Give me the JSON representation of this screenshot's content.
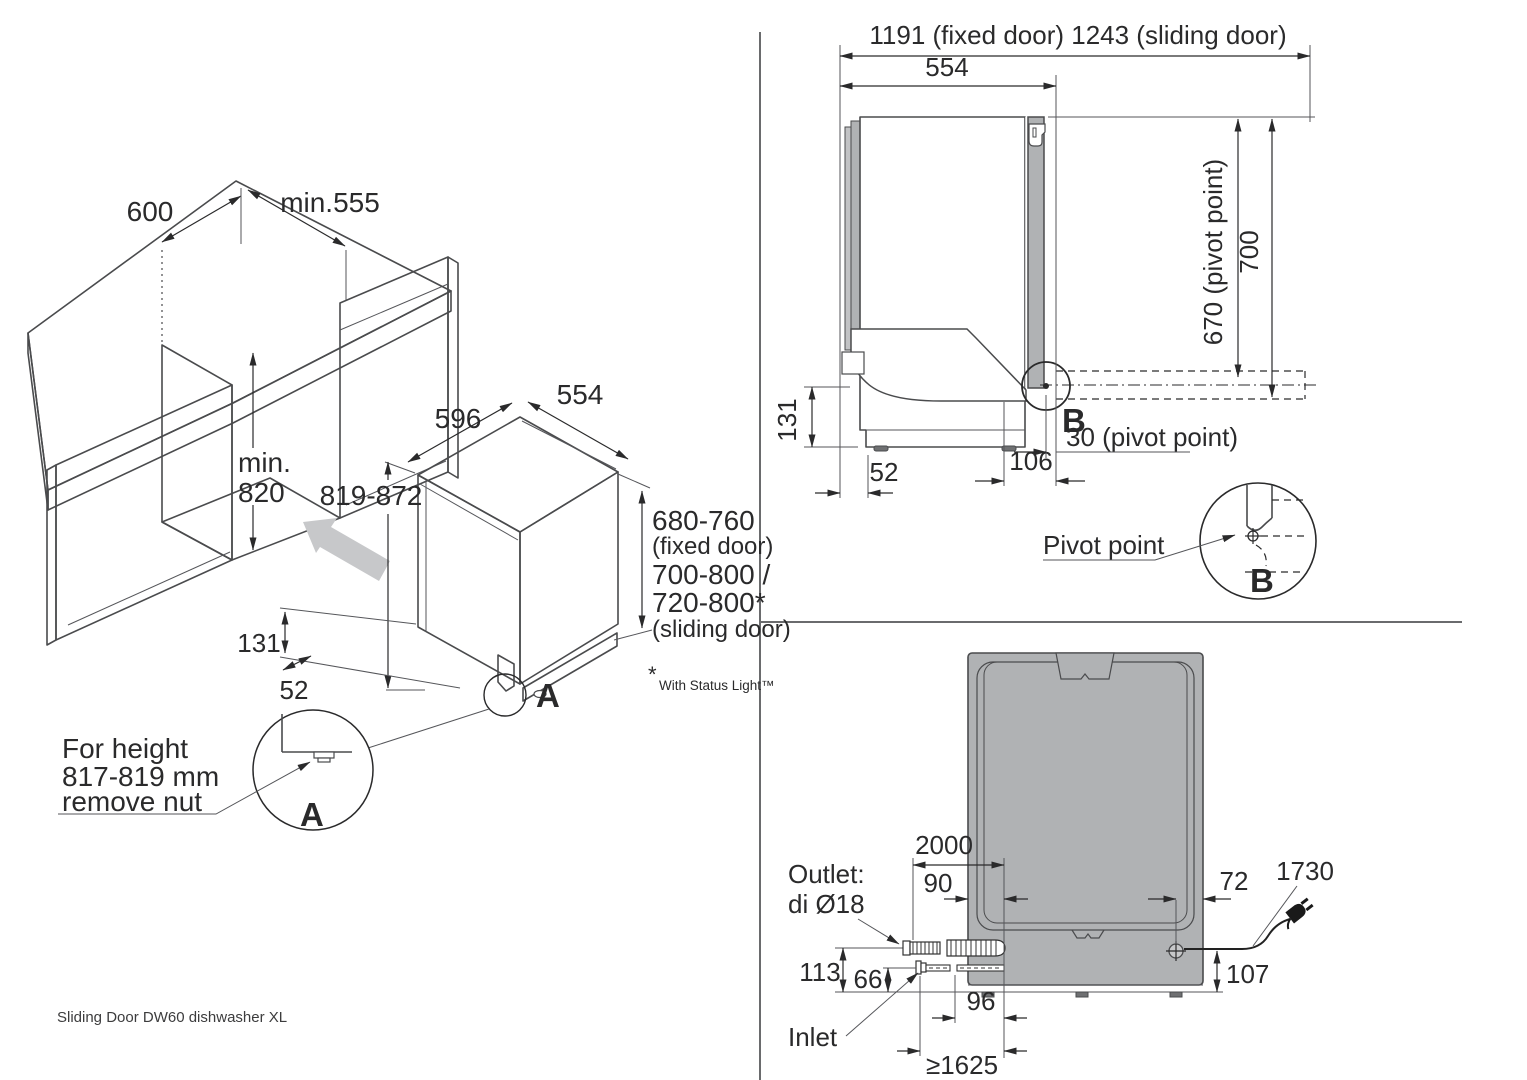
{
  "caption": "Sliding Door DW60 dishwasher XL",
  "footnote": {
    "star": "*",
    "text": "With Status Light™"
  },
  "cabinet": {
    "opening_width": "600",
    "opening_depth": "min.555",
    "opening_height_line1": "min.",
    "opening_height_line2": "820"
  },
  "iso": {
    "width": "596",
    "depth": "554",
    "height_range": "819-872",
    "plinth_height": "131",
    "toe_depth": "52",
    "door_fixed": "680-760",
    "door_fixed_note": "(fixed door)",
    "door_sliding_1": "700-800 /",
    "door_sliding_2": "720-800*",
    "door_sliding_note": "(sliding door)",
    "detail_label": "A"
  },
  "detail_a": {
    "note_line1": "For height",
    "note_line2": "817-819 mm",
    "note_line3": "remove nut",
    "label": "A"
  },
  "side": {
    "total_depth": "1191 (fixed door) 1243 (sliding door)",
    "body_depth": "554",
    "pivot_height": "670 (pivot point)",
    "total_height": "700",
    "plinth_height": "131",
    "toe_depth": "52",
    "pivot_offset": "106",
    "pivot_note": "30 (pivot point)",
    "detail_label": "B"
  },
  "pivot_detail": {
    "label": "Pivot point",
    "detail_label": "B"
  },
  "rear": {
    "outlet_hose": "2000",
    "outlet_offset": "90",
    "cord_offset": "72",
    "cord_length": "1730",
    "outlet_label_1": "Outlet:",
    "outlet_label_2": "di Ø18",
    "outlet_height": "113",
    "inlet_height": "66",
    "cord_height": "107",
    "inlet_offset": "96",
    "inlet_label": "Inlet",
    "inlet_hose": "≥1625"
  }
}
